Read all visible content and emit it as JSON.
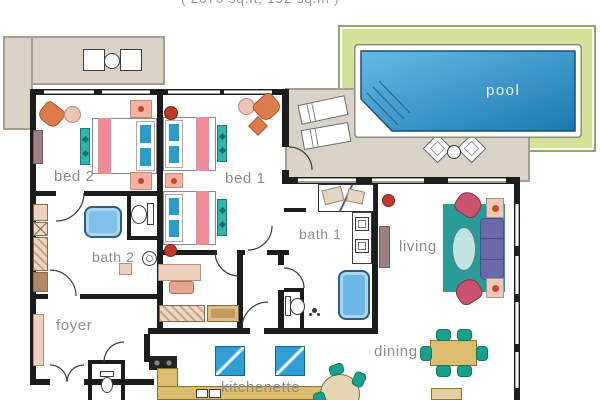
{
  "title": "( 2070 sq.ft; 192 sq.m )",
  "pool_label": "pool",
  "rooms": {
    "bed2": "bed 2",
    "bed1": "bed 1",
    "bath2": "bath 2",
    "bath1": "bath 1",
    "living": "living",
    "dining": "dining",
    "foyer": "foyer",
    "kitchenette": "kitchenette"
  },
  "colors": {
    "wall": "#1c1c1c",
    "pool_deck_green": "#d5e29a",
    "pool_water_light": "#62bbe5",
    "pool_water_dark": "#1e78b0",
    "terrace_beige": "#d9d3c7",
    "bed_stripe_pink": "#ef8b9a",
    "pillow_blue": "#2b9cc9",
    "bench_teal": "#2fb5ab",
    "sofa_purple": "#6a69a9",
    "rug_teal": "#2b9b97",
    "dining_tan": "#d9bc6d",
    "accent_orange": "#dd7d4d",
    "armchair_red": "#c9536e",
    "label_gray": "#8c8c8c"
  }
}
